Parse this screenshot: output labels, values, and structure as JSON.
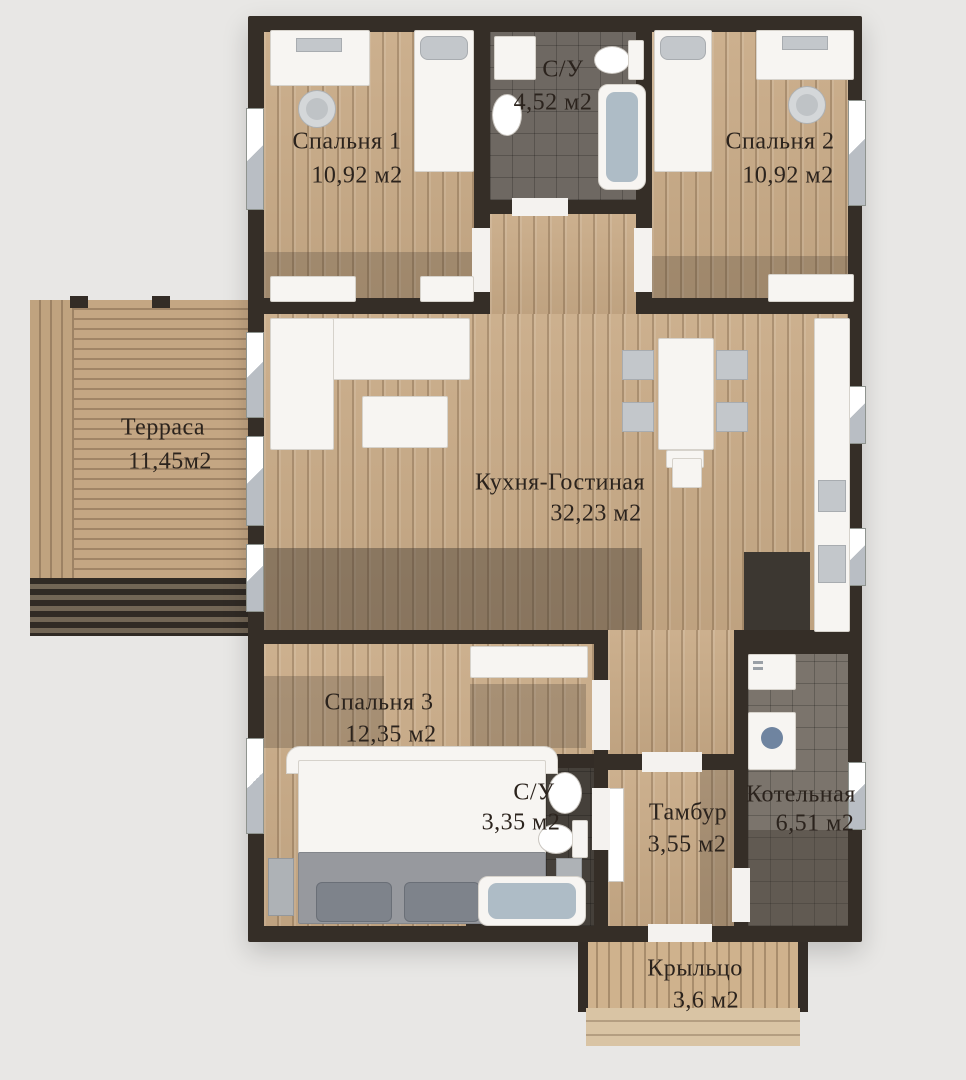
{
  "plan": {
    "rooms": [
      {
        "id": "bedroom1",
        "name": "Спальня 1",
        "area": "10,92 м2"
      },
      {
        "id": "bathroom1",
        "name": "С/У",
        "area": "4,52 м2"
      },
      {
        "id": "bedroom2",
        "name": "Спальня 2",
        "area": "10,92 м2"
      },
      {
        "id": "terrace",
        "name": "Терраса",
        "area": "11,45м2"
      },
      {
        "id": "kitchen_living",
        "name": "Кухня-Гостиная",
        "area": "32,23 м2"
      },
      {
        "id": "bedroom3",
        "name": "Спальня 3",
        "area": "12,35 м2"
      },
      {
        "id": "bathroom2",
        "name": "С/У",
        "area": "3,35 м2"
      },
      {
        "id": "vestibule",
        "name": "Тамбур",
        "area": "3,55 м2"
      },
      {
        "id": "boiler",
        "name": "Котельная",
        "area": "6,51 м2"
      },
      {
        "id": "porch",
        "name": "Крыльцо",
        "area": "3,6 м2"
      }
    ],
    "colors": {
      "wall": "#352e27",
      "floor_wood": "#c9ab87",
      "tile_grey": "#6e6862",
      "tile_dark": "#45403a",
      "background": "#e8e7e5",
      "label_text": "#2b231d"
    }
  }
}
